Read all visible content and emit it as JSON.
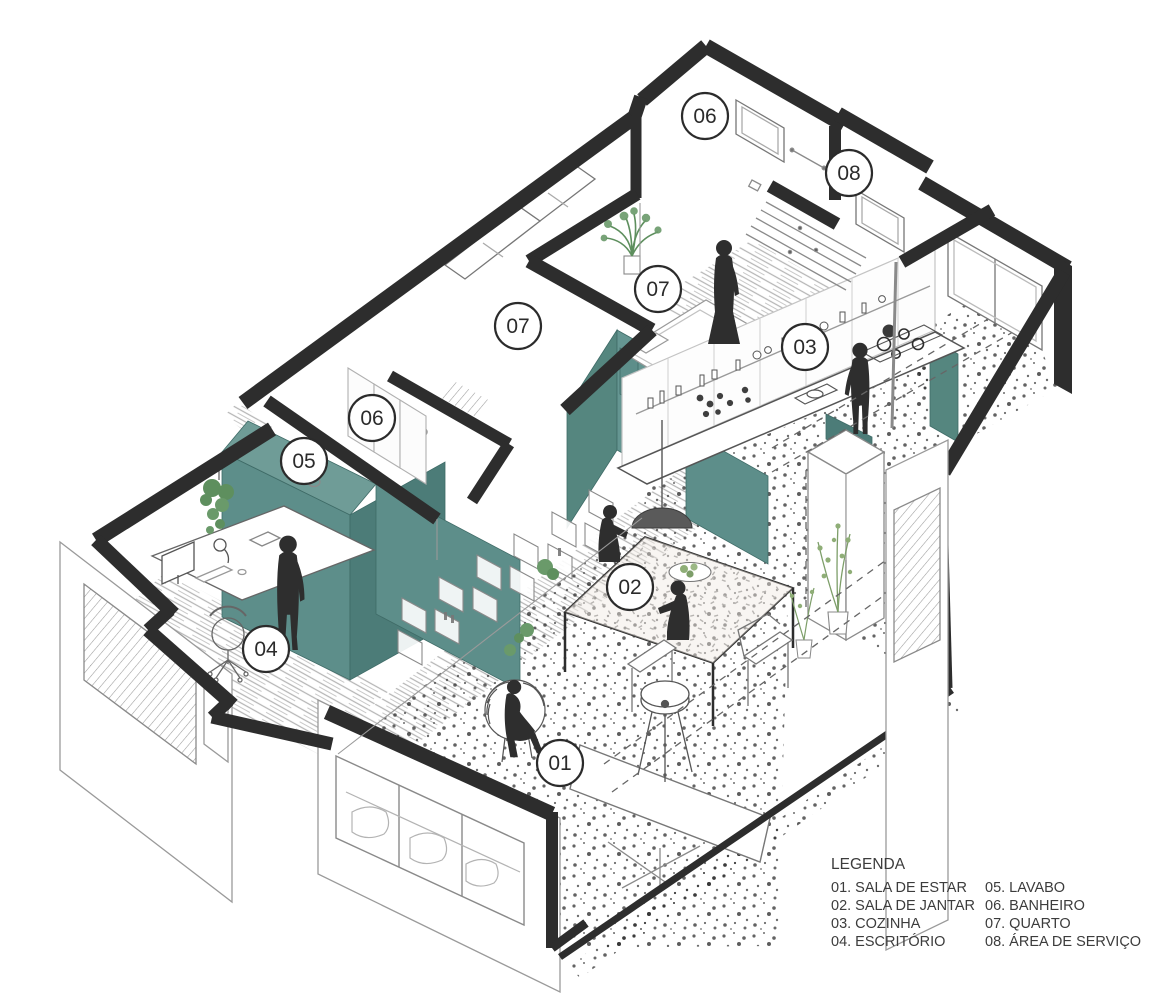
{
  "document": {
    "type": "axonometric apartment floor plan",
    "language": "pt-BR"
  },
  "rooms": [
    {
      "label": "06"
    },
    {
      "label": "08"
    },
    {
      "label": "07"
    },
    {
      "label": "03"
    },
    {
      "label": "07"
    },
    {
      "label": "06"
    },
    {
      "label": "05"
    },
    {
      "label": "04"
    },
    {
      "label": "02"
    },
    {
      "label": "01"
    }
  ],
  "legend": {
    "title": "LEGENDA",
    "items_left": [
      "01. SALA DE ESTAR",
      "02. SALA DE JANTAR",
      "03. COZINHA",
      "04. ESCRITÓRIO"
    ],
    "items_right": [
      "05. LAVABO",
      "06. BANHEIRO",
      "07. QUARTO",
      "08. ÁREA DE SERVIÇO"
    ]
  },
  "colors": {
    "cut_wall": "#2d2d2d",
    "teal": "#5d8e8a",
    "teal_dark": "#4c7c78",
    "teal_light": "#6f9c97",
    "plant_green": "#6a9a6a",
    "figure": "#2e2e2e"
  }
}
